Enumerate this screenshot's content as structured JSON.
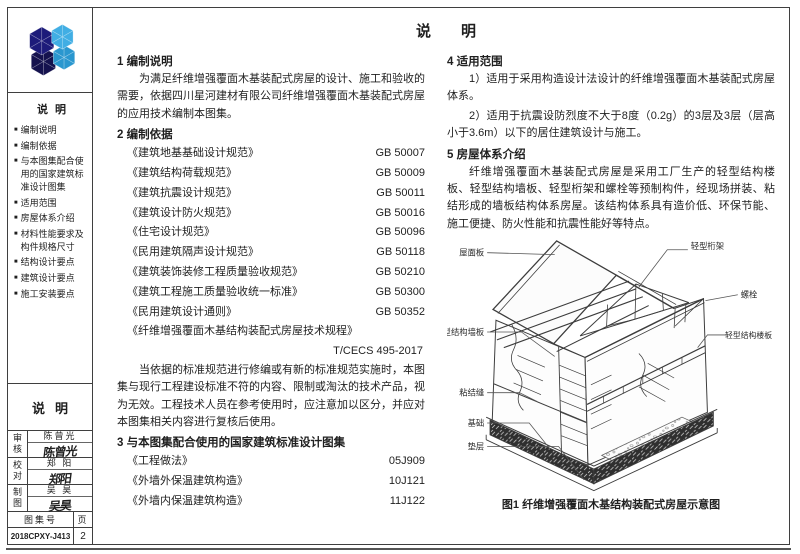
{
  "page": {
    "title": "说明"
  },
  "sidebar": {
    "toc": {
      "title": "说明",
      "items": [
        "编制说明",
        "编制依据",
        "与本图集配合使用的国家建筑标准设计图集",
        "适用范围",
        "房屋体系介绍",
        "材料性能要求及构件规格尺寸",
        "结构设计要点",
        "建筑设计要点",
        "施工安装要点"
      ]
    },
    "note_title": "说明",
    "approvals": [
      {
        "role": "审核",
        "name": "陈曾光",
        "signature": "陈曾光"
      },
      {
        "role": "校对",
        "name": "郑 阳",
        "signature": "郑阳"
      },
      {
        "role": "制图",
        "name": "吴 昊",
        "signature": "吴昊"
      }
    ],
    "footer": {
      "atlas_label": "图集号",
      "atlas_no": "2018CPXY-J413",
      "page_label": "页",
      "page_no": "2"
    }
  },
  "content": {
    "s1": {
      "heading": "1 编制说明",
      "para": "为满足纤维增强覆面木基装配式房屋的设计、施工和验收的需要，依据四川星河建材有限公司纤维增强覆面木基装配式房屋的应用技术编制本图集。"
    },
    "s2": {
      "heading": "2 编制依据",
      "standards": [
        {
          "name": "《建筑地基基础设计规范》",
          "code": "GB 50007"
        },
        {
          "name": "《建筑结构荷载规范》",
          "code": "GB 50009"
        },
        {
          "name": "《建筑抗震设计规范》",
          "code": "GB 50011"
        },
        {
          "name": "《建筑设计防火规范》",
          "code": "GB 50016"
        },
        {
          "name": "《住宅设计规范》",
          "code": "GB 50096"
        },
        {
          "name": "《民用建筑隔声设计规范》",
          "code": "GB 50118"
        },
        {
          "name": "《建筑装饰装修工程质量验收规范》",
          "code": "GB 50210"
        },
        {
          "name": "《建筑工程施工质量验收统一标准》",
          "code": "GB 50300"
        },
        {
          "name": "《民用建筑设计通则》",
          "code": "GB 50352"
        },
        {
          "name": "《纤维增强覆面木基结构装配式房屋技术规程》",
          "code": "T/CECS 495-2017"
        }
      ],
      "para": "当依据的标准规范进行修编或有新的标准规范实施时，本图集与现行工程建设标准不符的内容、限制或淘汰的技术产品，视为无效。工程技术人员在参考使用时，应注意加以区分，并应对本图集相关内容进行复核后使用。"
    },
    "s3": {
      "heading": "3 与本图集配合使用的国家建筑标准设计图集",
      "atlases": [
        {
          "name": "《工程做法》",
          "code": "05J909"
        },
        {
          "name": "《外墙外保温建筑构造》",
          "code": "10J121"
        },
        {
          "name": "《外墙内保温建筑构造》",
          "code": "11J122"
        }
      ]
    },
    "s4": {
      "heading": "4 适用范围",
      "item1": "1）适用于采用构造设计法设计的纤维增强覆面木基装配式房屋体系。",
      "item2": "2）适用于抗震设防烈度不大于8度（0.2g）的3层及3层（层高小于3.6m）以下的居住建筑设计与施工。"
    },
    "s5": {
      "heading": "5 房屋体系介绍",
      "para": "纤维增强覆面木基装配式房屋是采用工厂生产的轻型结构楼板、轻型结构墙板、轻型桁架和螺栓等预制构件，经现场拼装、粘结形成的墙板结构体系房屋。该结构体系具有造价低、环保节能、施工便捷、防火性能和抗震性能好等特点。"
    },
    "figure": {
      "labels": {
        "roof_panel": "屋面板",
        "truss": "轻型桁架",
        "bolt": "螺栓",
        "wall_panel": "轻型结构墙板",
        "floor_panel": "轻型结构楼板",
        "bond_joint": "粘结缝",
        "foundation": "基础",
        "cushion": "垫层"
      },
      "caption": "图1 纤维增强覆面木基结构装配式房屋示意图"
    },
    "colors": {
      "logo_dark": "#1d1b7a",
      "logo_dark2": "#15124e",
      "logo_light": "#41aee4",
      "logo_light2": "#2a97cf"
    }
  }
}
